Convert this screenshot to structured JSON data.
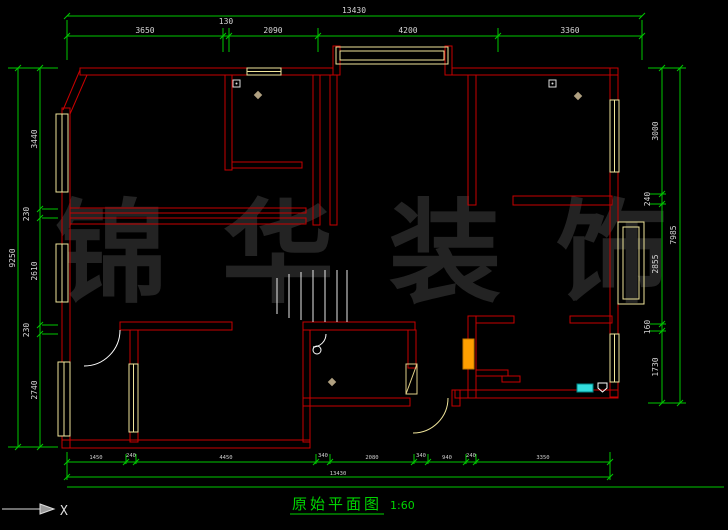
{
  "drawing": {
    "title": "原始平面图",
    "scale_label": "1:60",
    "watermark": "锦华装饰",
    "axis_label": "X"
  },
  "dimensions": {
    "top": {
      "total": "13430",
      "segments": [
        "3650",
        "130",
        "2090",
        "4200",
        "3360"
      ]
    },
    "left": {
      "total": "9250",
      "segments": [
        "3440",
        "230",
        "2610",
        "230",
        "2740"
      ]
    },
    "right": {
      "total": "7985",
      "segments": [
        "3000",
        "240",
        "2855",
        "160",
        "1730"
      ]
    },
    "bottom": {
      "total": "13430",
      "segments": [
        "1450",
        "240",
        "4450",
        "340",
        "2080",
        "340",
        "940",
        "240",
        "3350"
      ]
    }
  },
  "colors": {
    "background": "#000000",
    "wall": "#c80000",
    "window": "#efe49a",
    "dimension_line": "#00c800",
    "dimension_text": "#d6d6d6",
    "title_green": "#00d400",
    "watermark_gray": "#232323",
    "fixture_orange": "#ff9f00",
    "fixture_cyan": "#33dddd",
    "door_white": "#ffffff",
    "door_pale": "#efe49a"
  }
}
